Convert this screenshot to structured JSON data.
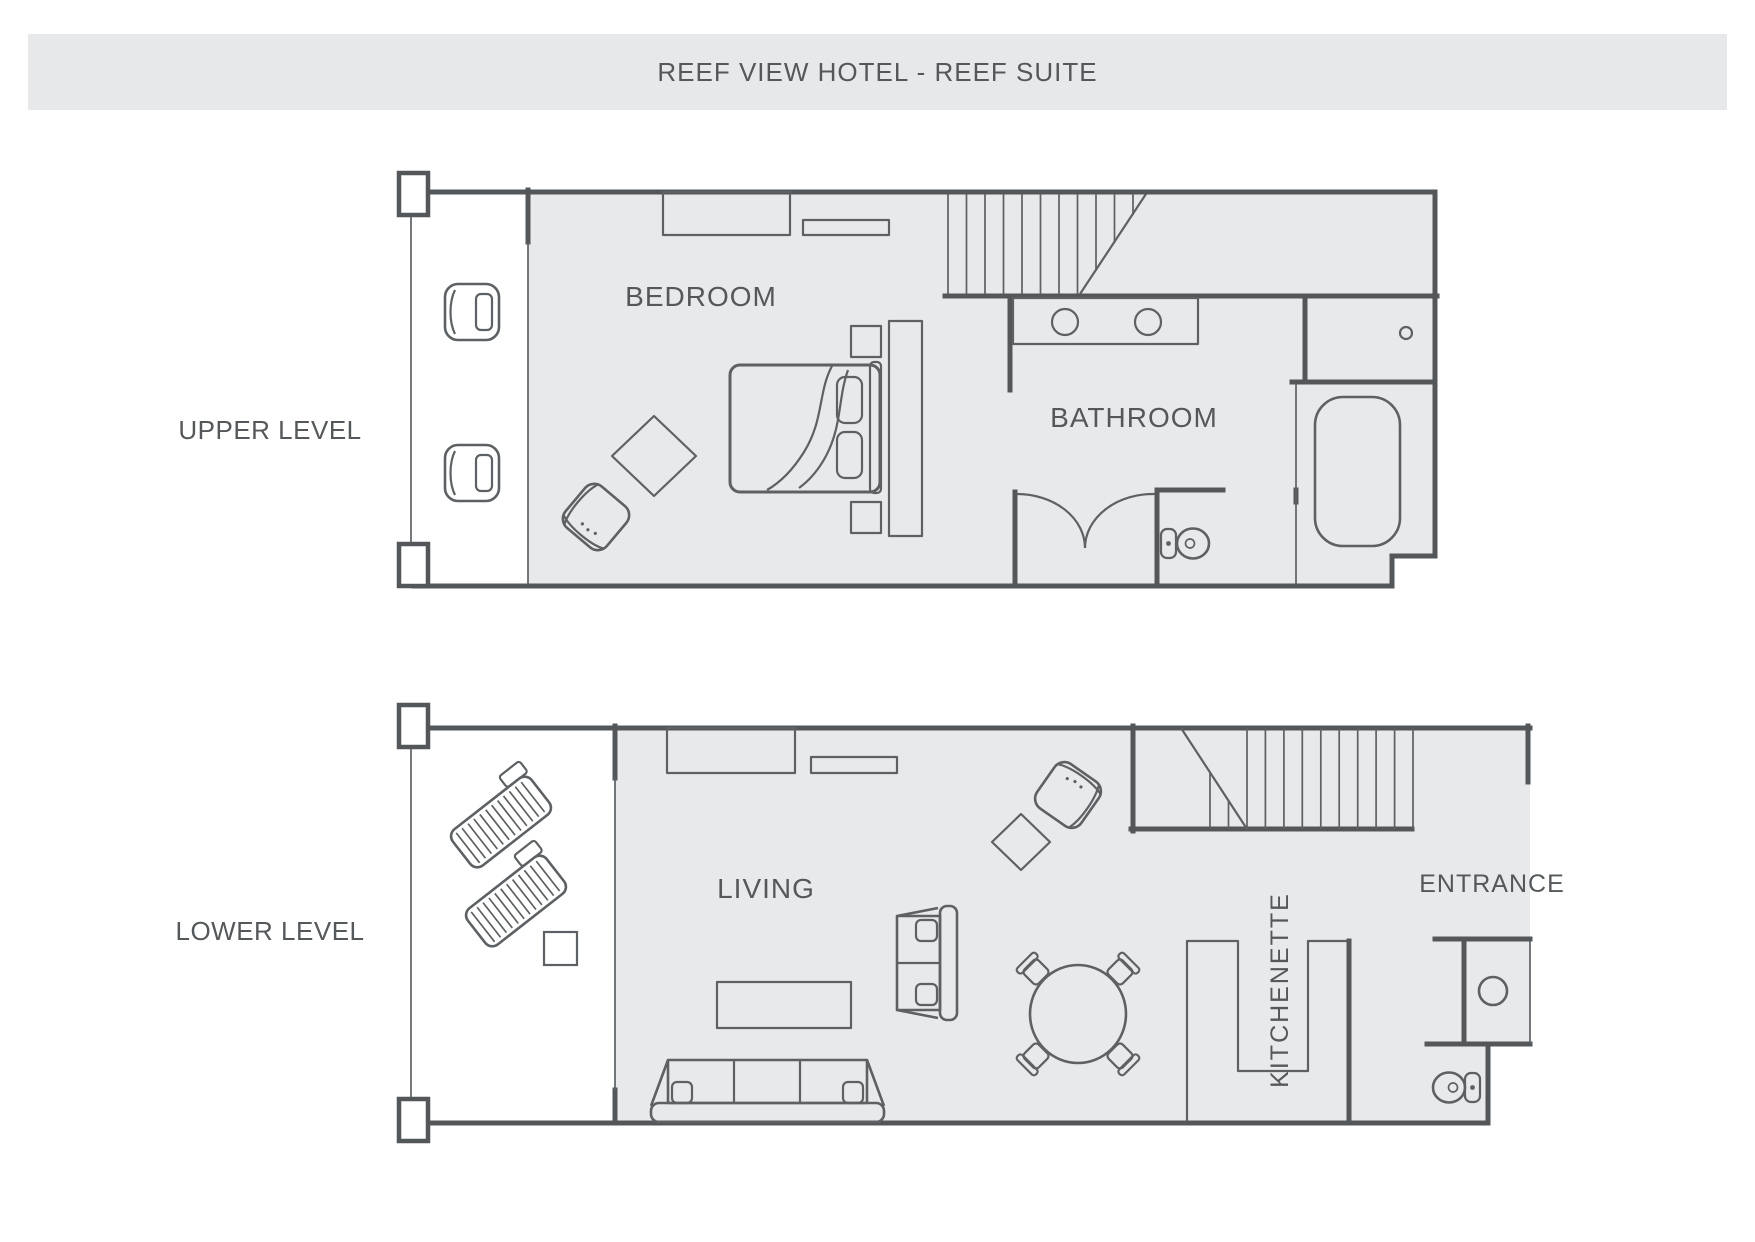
{
  "title": "REEF VIEW HOTEL - REEF SUITE",
  "colors": {
    "wall": "#54575a",
    "line": "#5d6164",
    "room": "#e8e9ea",
    "banner": "#e7e8ea",
    "text": "#55585b",
    "bg": "#ffffff"
  },
  "levels": [
    {
      "id": "upper",
      "label": "UPPER LEVEL",
      "rooms": [
        {
          "name": "BEDROOM"
        },
        {
          "name": "BATHROOM"
        }
      ],
      "features": [
        "balcony-chairs",
        "wardrobe",
        "shelf",
        "double-bed",
        "nightstands",
        "rug",
        "armchair",
        "staircase",
        "vanity-two-sinks",
        "shower",
        "bathtub",
        "toilet",
        "closet-double-doors"
      ]
    },
    {
      "id": "lower",
      "label": "LOWER LEVEL",
      "rooms": [
        {
          "name": "LIVING"
        },
        {
          "name": "KITCHENETTE"
        },
        {
          "name": "ENTRANCE"
        }
      ],
      "features": [
        "sun-loungers",
        "side-table",
        "tv-console",
        "shelf",
        "armchair",
        "rug",
        "sofa",
        "loveseat",
        "coffee-table",
        "dining-table-four-chairs",
        "staircase",
        "kitchen-counter",
        "laundry-closet-washer",
        "toilet"
      ]
    }
  ]
}
